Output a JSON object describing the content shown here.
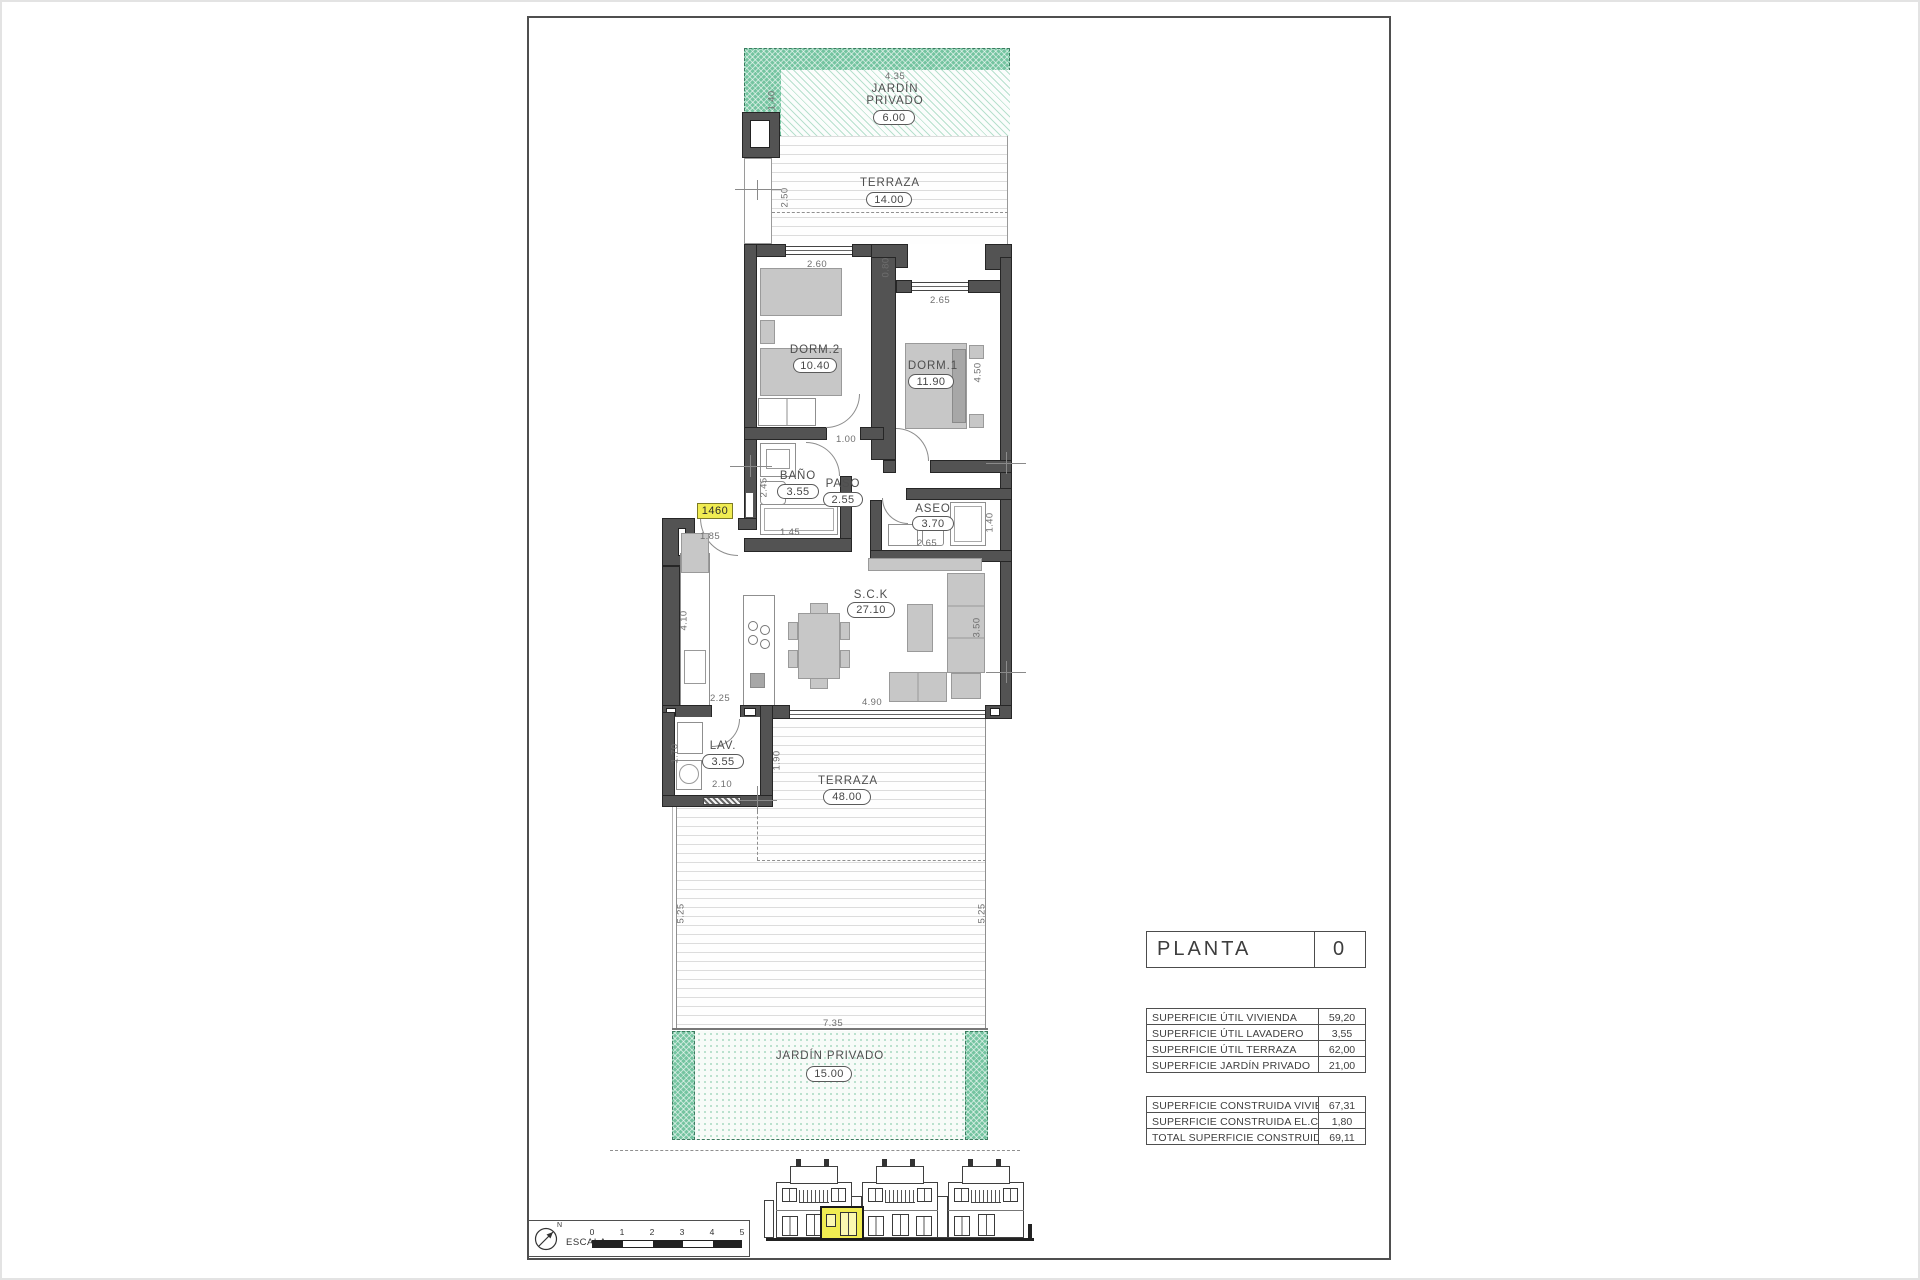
{
  "colors": {
    "wall": "#535353",
    "garden_green": "#74c4a0",
    "highlight_yellow": "#f0ec52",
    "furniture_gray": "#c7c7c7"
  },
  "plan": {
    "unit_label": "1460",
    "rooms": {
      "jardin_top": {
        "name": "JARDÍN",
        "name2": "PRIVADO",
        "area": "6.00"
      },
      "terraza_top": {
        "name": "TERRAZA",
        "area": "14.00"
      },
      "dorm2": {
        "name": "DORM.2",
        "area": "10.40"
      },
      "dorm1": {
        "name": "DORM.1",
        "area": "11.90"
      },
      "bano": {
        "name": "BAÑO",
        "area": "3.55"
      },
      "paso": {
        "name": "PASO",
        "area": "2.55"
      },
      "aseo": {
        "name": "ASEO",
        "area": "3.70"
      },
      "sck": {
        "name": "S.C.K",
        "area": "27.10"
      },
      "lav": {
        "name": "LAV.",
        "area": "3.55"
      },
      "terraza_main": {
        "name": "TERRAZA",
        "area": "48.00"
      },
      "jardin_bottom": {
        "name": "JARDÍN  PRIVADO",
        "area": "15.00"
      }
    },
    "dims": {
      "jardin_top_width": "4.35",
      "jardin_top_height": "1.40",
      "terraza_top_width": "4.85",
      "terraza_top_height": "2.50",
      "dorm2_window": "2.60",
      "wall_step": "0.80",
      "dorm1_window": "2.65",
      "dorm1_height": "4.50",
      "paso_top": "1.00",
      "bano_height": "2.45",
      "bano_width": "1.45",
      "entry_width": "1.85",
      "aseo_width": "2.65",
      "aseo_height": "1.40",
      "kitchen_height": "4.10",
      "kitchen_width": "2.25",
      "living_height": "3.50",
      "living_width": "4.90",
      "lav_left": "1.70",
      "lav_width": "2.10",
      "lav_right": "1.90",
      "terraza_left": "5.25",
      "terraza_right": "5.25",
      "jardin_bottom_width": "7.35"
    }
  },
  "title_block": {
    "label": "PLANTA",
    "value": "0"
  },
  "areas": {
    "util_rows": [
      {
        "label": "SUPERFICIE ÚTIL VIVIENDA",
        "value": "59,20"
      },
      {
        "label": "SUPERFICIE ÚTIL LAVADERO",
        "value": "3,55"
      },
      {
        "label": "SUPERFICIE ÚTIL TERRAZA",
        "value": "62,00"
      },
      {
        "label": "SUPERFICIE JARDÍN PRIVADO",
        "value": "21,00"
      }
    ],
    "construida_rows": [
      {
        "label": "SUPERFICIE CONSTRUIDA VIVIENDA",
        "value": "67,31"
      },
      {
        "label": "SUPERFICIE CONSTRUIDA EL.COMUNES",
        "value": "1,80"
      },
      {
        "label": "TOTAL SUPERFICIE CONSTRUIDA",
        "value": "69,11"
      }
    ]
  },
  "scale_bar": {
    "label": "ESCALA :",
    "north": "N",
    "ticks": [
      "0",
      "1",
      "2",
      "3",
      "4",
      "5"
    ]
  }
}
